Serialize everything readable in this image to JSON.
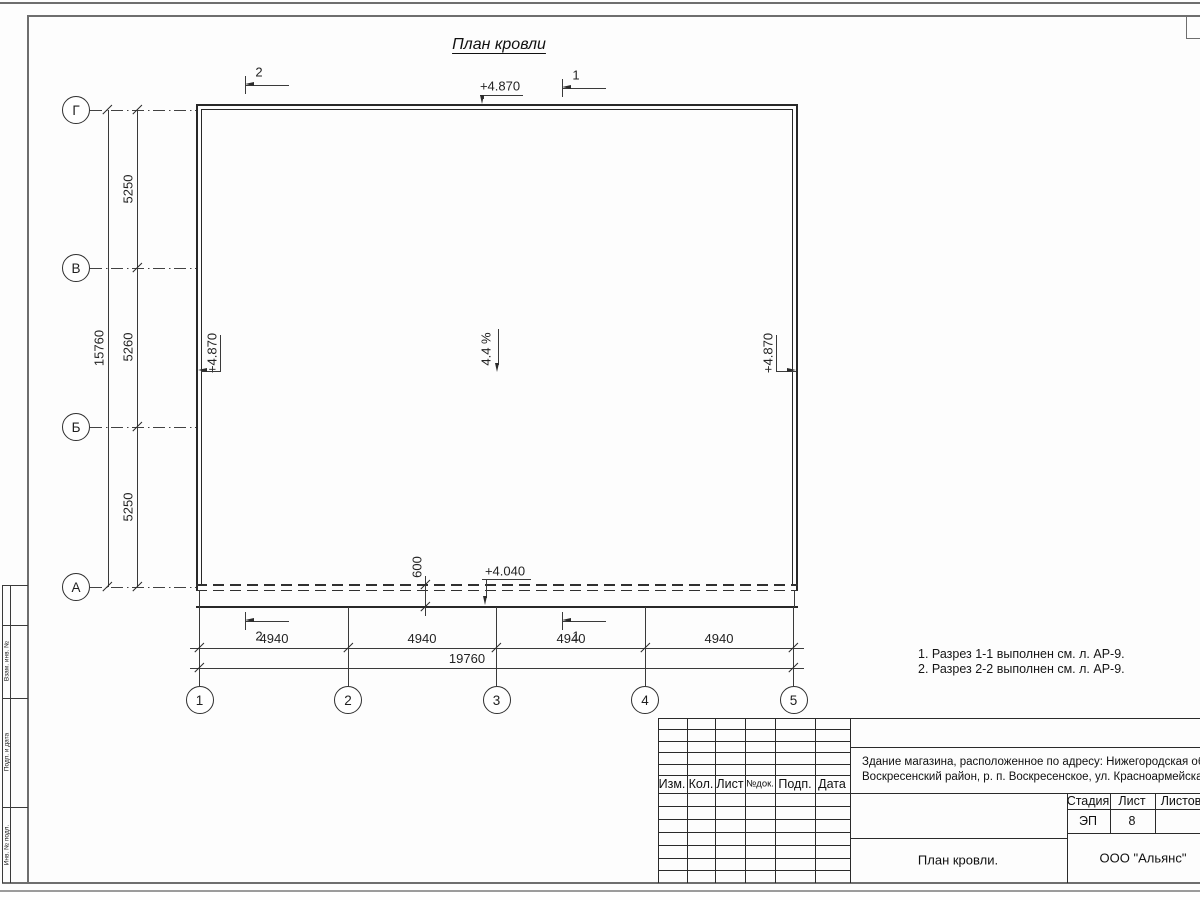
{
  "drawing": {
    "title": "План кровли",
    "slope_label": "4.4 %",
    "row_axes": [
      "Г",
      "В",
      "Б",
      "А"
    ],
    "col_axes": [
      "1",
      "2",
      "3",
      "4",
      "5"
    ],
    "dim_left_segments": [
      "5250",
      "5260",
      "5250"
    ],
    "dim_left_total": "15760",
    "dim_bottom_segments": [
      "4940",
      "4940",
      "4940",
      "4940"
    ],
    "dim_bottom_total": "19760",
    "dim_eave": "600",
    "elev_top": "+4.870",
    "elev_left": "+4.870",
    "elev_right": "+4.870",
    "elev_eave": "+4.040",
    "sections": {
      "top_left": "2",
      "top_right": "1",
      "bottom_left": "2",
      "bottom_right": "1"
    },
    "notes": [
      "1. Разрез 1-1 выполнен см. л. АР-9.",
      "2. Разрез 2-2 выполнен см. л. АР-9."
    ]
  },
  "title_block": {
    "columns": [
      "Изм.",
      "Кол.",
      "Лист",
      "№док.",
      "Подп.",
      "Дата"
    ],
    "address_line1": "Здание магазина, расположенное по адресу: Нижегородская область,",
    "address_line2": "Воскресенский район, р. п. Воскресенское, ул. Красноармейская, д. 1",
    "stage_label": "Стадия",
    "sheet_label": "Лист",
    "sheets_label": "Листов",
    "stage_value": "ЭП",
    "sheet_value": "8",
    "doc_title": "План кровли.",
    "organization": "ООО \"Альянс\""
  },
  "side_strip": {
    "labels": [
      "Взам. инв. №",
      "Подп. и дата",
      "Инв. № подл."
    ]
  }
}
